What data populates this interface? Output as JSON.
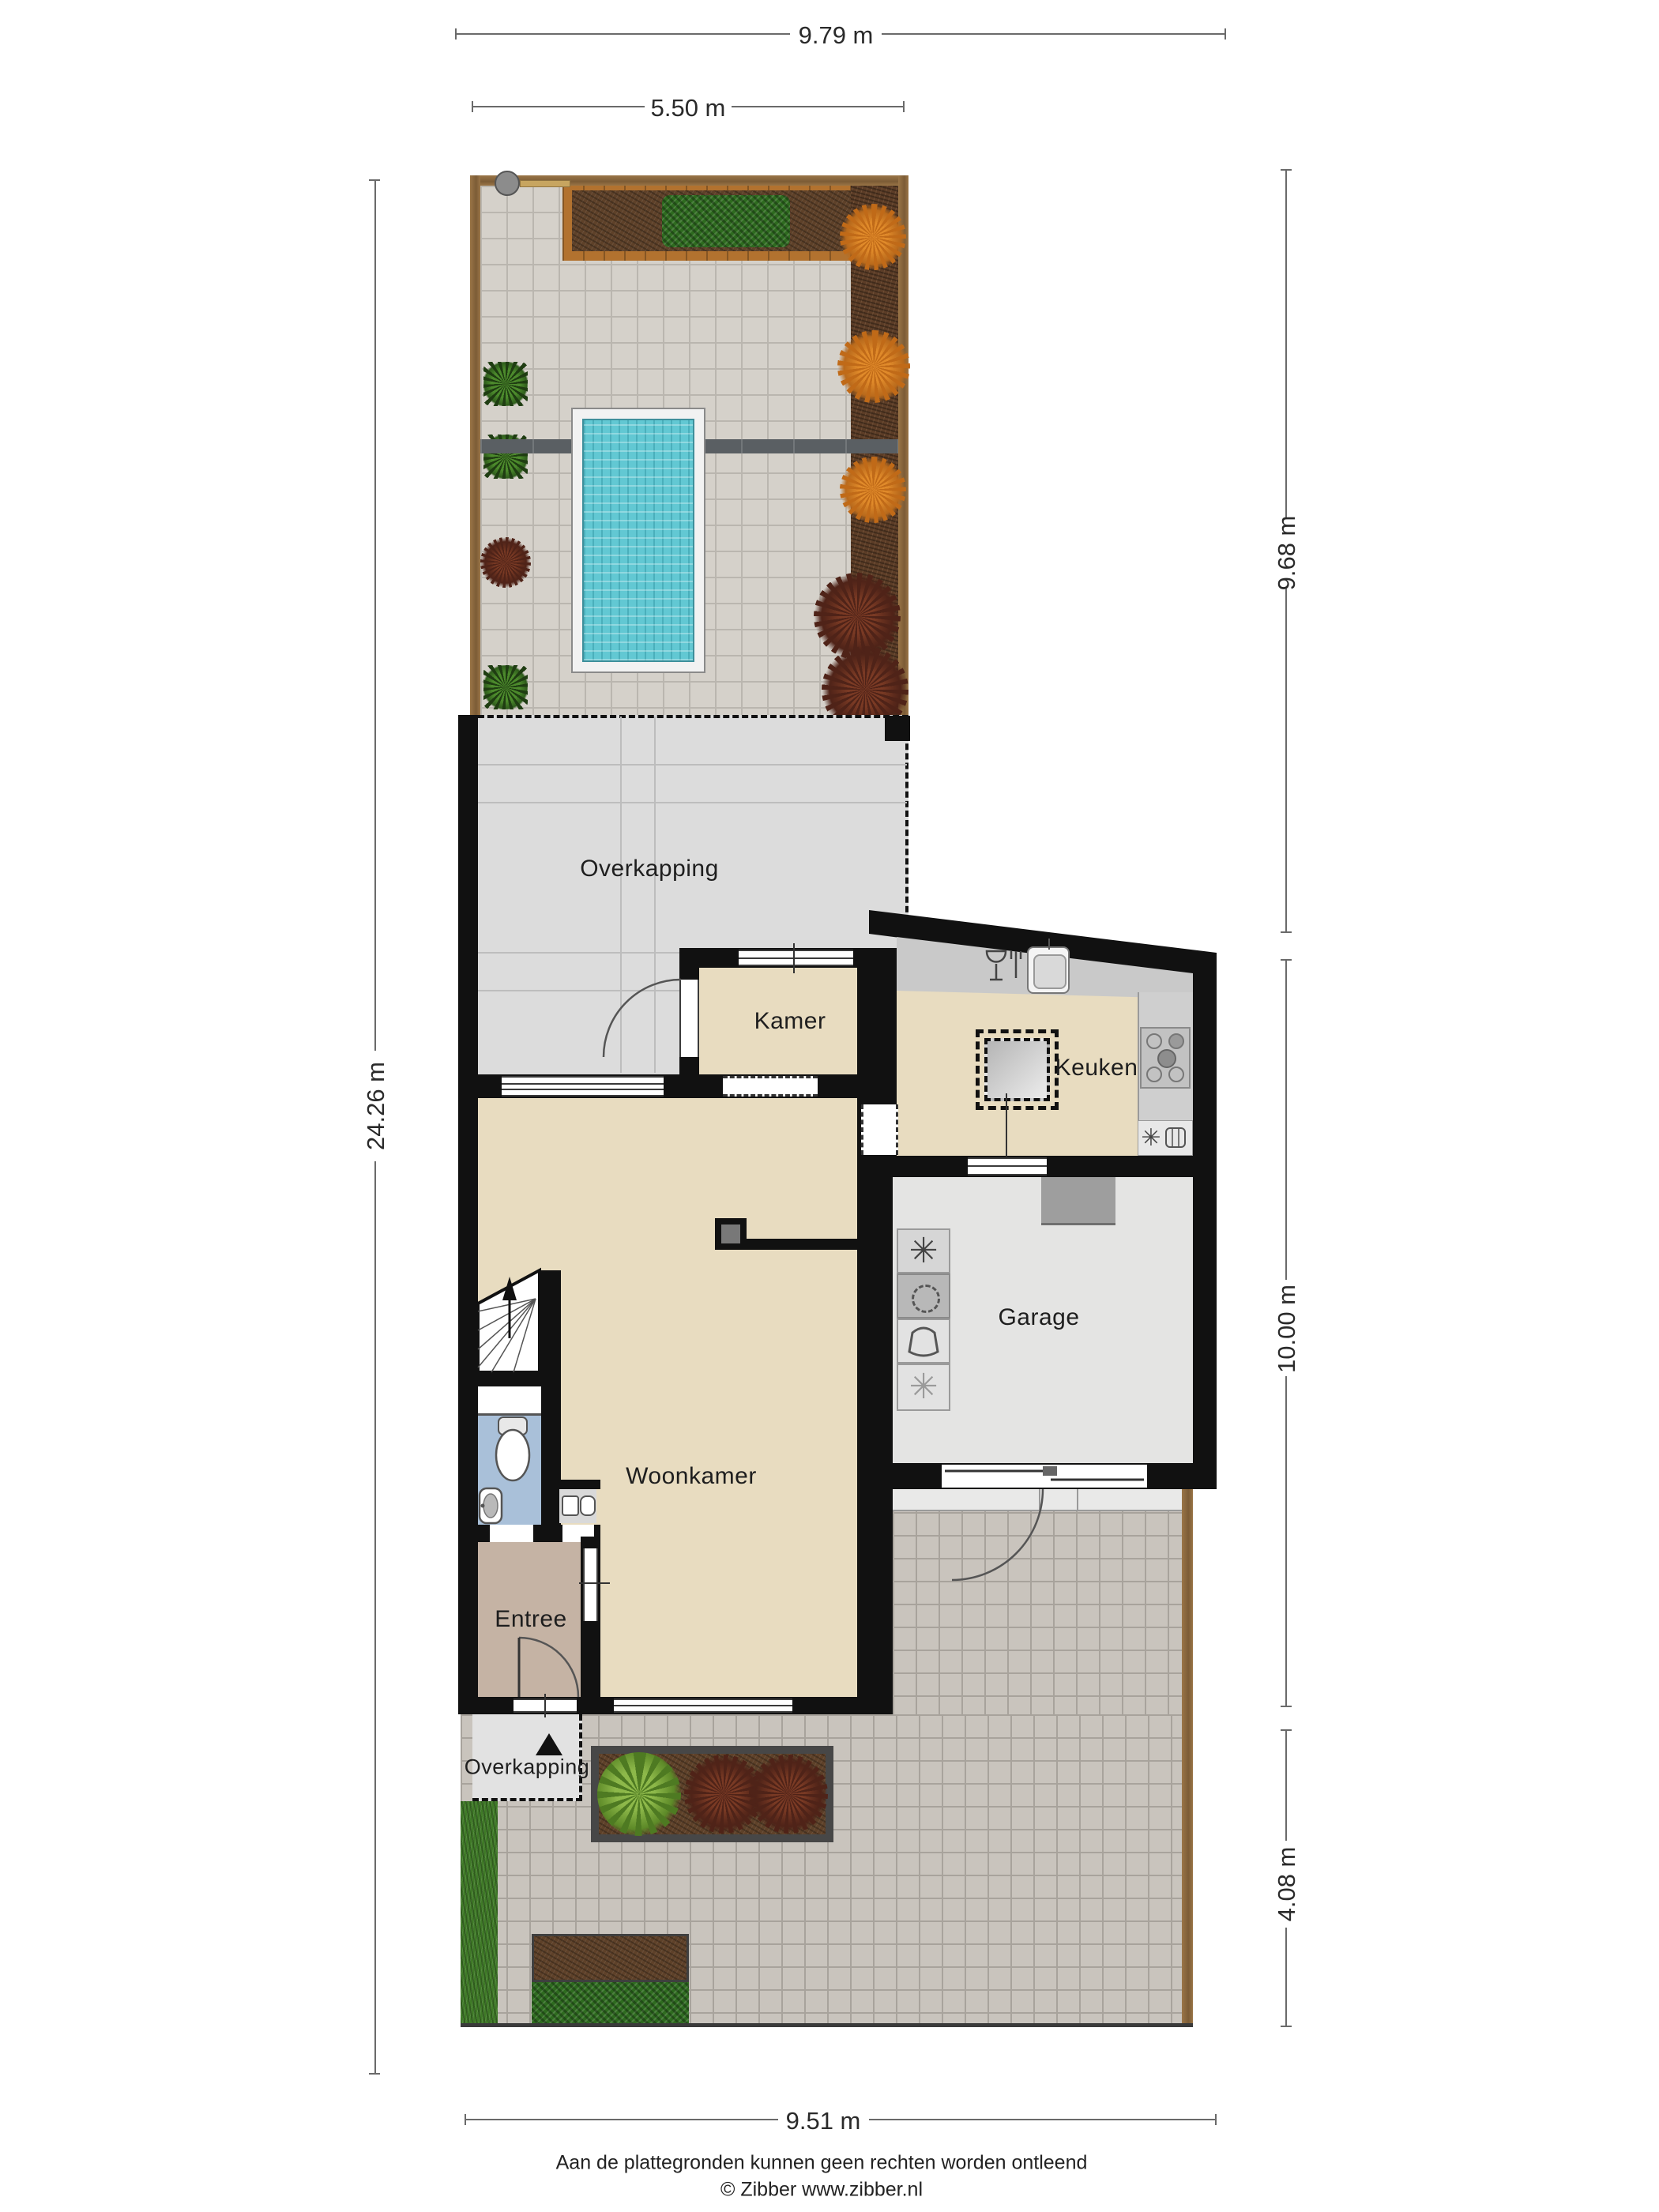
{
  "plan": {
    "title": "Begane grond met tuin (plattegrond)",
    "rooms": {
      "overkapping_boven": "Overkapping",
      "kamer": "Kamer",
      "keuken": "Keuken",
      "garage": "Garage",
      "woonkamer": "Woonkamer",
      "entree": "Entree",
      "overkapping_voor": "Overkapping"
    },
    "dimensions": {
      "top_total": "9.79 m",
      "top_garden": "5.50 m",
      "left_total": "24.26 m",
      "right_garden": "9.68 m",
      "right_house": "10.00 m",
      "right_front": "4.08 m",
      "bottom_total": "9.51 m"
    },
    "footer": {
      "disclaimer": "Aan de plattegronden kunnen geen rechten worden ontleend",
      "copyright": "© Zibber www.zibber.nl"
    },
    "icons": [
      "freezer-snowflake-icon",
      "washing-machine-icon",
      "laundry-basket-icon",
      "dishwasher-icon",
      "sink-icon",
      "gas-hob-icon",
      "oven-icon",
      "toilet-icon",
      "washbasin-icon",
      "meter-cupboard-icon",
      "stairs-up-arrow-icon",
      "entrance-arrow-icon",
      "garden-gate-icon"
    ],
    "colors": {
      "wall": "#111111",
      "room_floor": "#e8dcc0",
      "entree_floor": "#c5b3a4",
      "toilet_floor": "#a9c0d9",
      "garage_floor": "#e4e4e3",
      "overkapping_floor": "#dcdcdc",
      "garden_paving": "#d5d1ca",
      "street_paving": "#c9c4bd",
      "pool_water": "#62c8d3",
      "grass": "#3f7a27",
      "soil": "#5e4129",
      "hedge": "#2e6b1f",
      "fence_wood": "#8a6a42",
      "counter": "#c9c9c9",
      "plant_orange": "#d07a20",
      "plant_red": "#53241a"
    }
  }
}
